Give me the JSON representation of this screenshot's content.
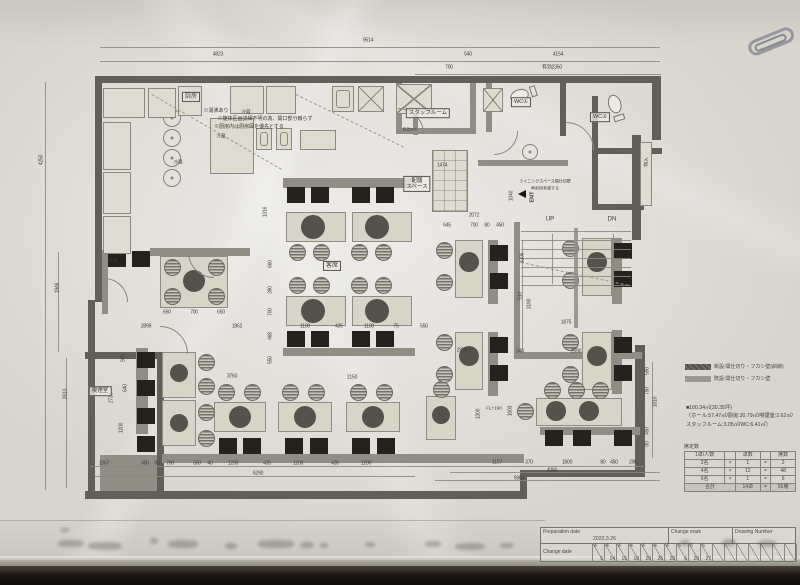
{
  "legend": {
    "items": [
      {
        "label": "新設:間仕切り・フカシ壁(斜線)",
        "swatch_color": "#504e47"
      },
      {
        "label": "既設:間仕切り・フカシ壁",
        "swatch_color": "#9b988f"
      }
    ]
  },
  "area_summary": {
    "line1": "■100.34㎡(30.35坪)",
    "line2": "〔ホール:57.47㎡/厨房:30.79㎡/喫煙室:2.62㎡/",
    "line3": "スタッフルーム:3.05㎡/WC:6.41㎡〕"
  },
  "seat_table": {
    "title": "席定数",
    "headers": [
      "1卓/人数",
      "卓数",
      "席数"
    ],
    "rows": [
      [
        "2名",
        "×",
        "1",
        "=",
        "2"
      ],
      [
        "4名",
        "×",
        "12",
        "=",
        "48"
      ],
      [
        "6名",
        "×",
        "1",
        "=",
        "6"
      ]
    ],
    "total_label": "合計",
    "total_tables": "14卓",
    "total_seats": "56席"
  },
  "title_block": {
    "prep_label": "Preparation date",
    "prep_date": "2022.3.26",
    "change_mark_label": "Change mark",
    "drawing_number_label": "Drawing Number",
    "change_date_label": "Change date",
    "change_dates": [
      "4/5",
      "4/14",
      "4/15",
      "4/18",
      "4/20",
      "4/26",
      "4/28",
      "5/6",
      "5/20",
      "5/27",
      "",
      "",
      "",
      "",
      "",
      "",
      ""
    ]
  },
  "plan": {
    "labels": [
      {
        "t": "厨房",
        "x": 191,
        "y": 97,
        "b": 1,
        "s": 6
      },
      {
        "t": "※湯沸あり",
        "x": 216,
        "y": 111,
        "s": 5
      },
      {
        "t": "※躯体区画詳細不明の為、開口部分触らず",
        "x": 265,
        "y": 119,
        "s": 5
      },
      {
        "t": "※厨房内は厨房図を優先とする",
        "x": 249,
        "y": 127,
        "s": 5
      },
      {
        "t": "冷蔵",
        "x": 246,
        "y": 112,
        "s": 4.5
      },
      {
        "t": "冷蔵",
        "x": 221,
        "y": 136,
        "s": 4.5
      },
      {
        "t": "冷蔵",
        "x": 178,
        "y": 162,
        "s": 4.5
      },
      {
        "t": "冷蔵",
        "x": 113,
        "y": 261,
        "s": 4.5
      },
      {
        "t": "スタッフルーム",
        "x": 428,
        "y": 113,
        "b": 1,
        "s": 5.5
      },
      {
        "t": "WC①",
        "x": 521,
        "y": 102,
        "b": 1,
        "s": 5.5
      },
      {
        "t": "WC②",
        "x": 600,
        "y": 117,
        "b": 1,
        "s": 5.5
      },
      {
        "t": "配膳\nスペース",
        "x": 417,
        "y": 184,
        "b": 1,
        "s": 5.5
      },
      {
        "t": "客席",
        "x": 332,
        "y": 266,
        "b": 1,
        "s": 6
      },
      {
        "t": "喫煙室",
        "x": 100,
        "y": 391,
        "b": 1,
        "s": 5.5
      },
      {
        "t": "UP",
        "x": 550,
        "y": 220,
        "s": 6
      },
      {
        "t": "DN",
        "x": 612,
        "y": 220,
        "s": 6
      },
      {
        "t": "ENT",
        "x": 533,
        "y": 197,
        "v": 1,
        "s": 5.5,
        "bold": 1
      },
      {
        "t": "物入",
        "x": 646,
        "y": 162,
        "v": 1,
        "s": 4.5
      },
      {
        "t": "ライニングスペース間仕切壁",
        "x": 545,
        "y": 182,
        "s": 4
      },
      {
        "t": "再利用考慮する",
        "x": 545,
        "y": 189,
        "s": 4
      },
      {
        "t": "有効920",
        "x": 410,
        "y": 130,
        "s": 4
      },
      {
        "t": "FL+190",
        "x": 494,
        "y": 408,
        "s": 4.5
      }
    ],
    "dims": [
      [
        "9514",
        368,
        41,
        0
      ],
      [
        "4823",
        218,
        55,
        0
      ],
      [
        "540",
        468,
        55,
        0
      ],
      [
        "4154",
        558,
        55,
        0
      ],
      [
        "700",
        449,
        68,
        0
      ],
      [
        "有効2350",
        552,
        68,
        0
      ],
      [
        "1067",
        104,
        464,
        0
      ],
      [
        "450",
        145,
        464,
        0
      ],
      [
        "80",
        157,
        464,
        0
      ],
      [
        "700",
        170,
        464,
        0
      ],
      [
        "350",
        197,
        464,
        0
      ],
      [
        "40",
        210,
        464,
        0
      ],
      [
        "1200",
        233,
        464,
        0
      ],
      [
        "435",
        267,
        464,
        0
      ],
      [
        "1200",
        298,
        464,
        0
      ],
      [
        "435",
        335,
        464,
        0
      ],
      [
        "1200",
        366,
        464,
        0
      ],
      [
        "6290",
        258,
        474,
        0
      ],
      [
        "1157",
        497,
        463,
        0
      ],
      [
        "370",
        529,
        463,
        0
      ],
      [
        "1800",
        567,
        463,
        0
      ],
      [
        "80",
        603,
        463,
        0
      ],
      [
        "450",
        614,
        463,
        0
      ],
      [
        "295",
        633,
        463,
        0
      ],
      [
        "4060",
        552,
        471,
        0
      ],
      [
        "5983",
        519,
        479,
        0
      ],
      [
        "4250",
        42,
        160,
        1
      ],
      [
        "1946",
        58,
        288,
        1
      ],
      [
        "2610",
        66,
        394,
        1
      ],
      [
        "650",
        167,
        313,
        0
      ],
      [
        "700",
        194,
        313,
        0
      ],
      [
        "650",
        221,
        313,
        0
      ],
      [
        "2899",
        146,
        327,
        0
      ],
      [
        "1862",
        237,
        327,
        0
      ],
      [
        "1100",
        305,
        327,
        0
      ],
      [
        "435",
        339,
        327,
        0
      ],
      [
        "1100",
        369,
        327,
        0
      ],
      [
        "75",
        396,
        327,
        0
      ],
      [
        "550",
        424,
        327,
        0
      ],
      [
        "1875",
        566,
        323,
        0
      ],
      [
        "2072",
        474,
        216,
        0
      ],
      [
        "645",
        447,
        226,
        0
      ],
      [
        "700",
        474,
        226,
        0
      ],
      [
        "80",
        487,
        226,
        0
      ],
      [
        "450",
        500,
        226,
        0
      ],
      [
        "1474",
        442,
        166,
        0
      ],
      [
        "2150",
        352,
        378,
        0
      ],
      [
        "3760",
        232,
        377,
        0
      ],
      [
        "2950",
        462,
        351,
        0
      ],
      [
        "1300",
        479,
        414,
        1
      ],
      [
        "1603",
        511,
        411,
        1
      ],
      [
        "2590",
        576,
        352,
        0
      ],
      [
        "340",
        520,
        352,
        0
      ],
      [
        "1040",
        512,
        196,
        1
      ],
      [
        "1306",
        523,
        258,
        1
      ],
      [
        "510",
        521,
        296,
        1
      ],
      [
        "3190",
        530,
        304,
        1
      ],
      [
        "900",
        124,
        358,
        1
      ],
      [
        "2730",
        112,
        398,
        1
      ],
      [
        "640",
        126,
        388,
        1
      ],
      [
        "1200",
        122,
        428,
        1
      ],
      [
        "1316",
        266,
        212,
        1
      ],
      [
        "660",
        271,
        264,
        1
      ],
      [
        "390",
        271,
        290,
        1
      ],
      [
        "700",
        271,
        312,
        1
      ],
      [
        "468",
        271,
        336,
        1
      ],
      [
        "550",
        271,
        360,
        1
      ],
      [
        "590",
        648,
        371,
        1
      ],
      [
        "750",
        648,
        391,
        1
      ],
      [
        "1810",
        656,
        402,
        1
      ],
      [
        "450",
        648,
        431,
        1
      ],
      [
        "80",
        648,
        444,
        1
      ]
    ],
    "walls": [
      [
        95,
        76,
        566,
        7,
        "d"
      ],
      [
        652,
        76,
        9,
        64,
        "d"
      ],
      [
        95,
        76,
        7,
        226,
        "d"
      ],
      [
        88,
        300,
        7,
        198,
        "d"
      ],
      [
        85,
        491,
        442,
        8,
        "d"
      ],
      [
        520,
        470,
        124,
        7,
        "d"
      ],
      [
        520,
        470,
        7,
        28,
        "d"
      ],
      [
        637,
        412,
        8,
        65,
        "d"
      ],
      [
        632,
        135,
        9,
        105,
        "d"
      ],
      [
        635,
        345,
        10,
        132,
        "d"
      ],
      [
        100,
        455,
        62,
        36,
        "m"
      ],
      [
        85,
        352,
        79,
        7,
        "d"
      ],
      [
        157,
        352,
        7,
        139,
        "d"
      ],
      [
        396,
        83,
        6,
        51,
        "m"
      ],
      [
        396,
        128,
        80,
        6,
        "m"
      ],
      [
        470,
        83,
        6,
        51,
        "m"
      ],
      [
        486,
        83,
        6,
        49,
        "m"
      ],
      [
        560,
        83,
        6,
        53,
        "d"
      ],
      [
        592,
        96,
        6,
        58,
        "d"
      ],
      [
        592,
        148,
        70,
        6,
        "d"
      ],
      [
        592,
        154,
        6,
        56,
        "d"
      ],
      [
        592,
        204,
        52,
        6,
        "d"
      ],
      [
        478,
        160,
        90,
        6,
        "m"
      ],
      [
        514,
        222,
        6,
        135,
        "m"
      ],
      [
        514,
        352,
        128,
        7,
        "m"
      ],
      [
        283,
        178,
        132,
        10,
        "m"
      ],
      [
        150,
        248,
        100,
        8,
        "m"
      ],
      [
        102,
        250,
        6,
        64,
        "m"
      ],
      [
        283,
        348,
        132,
        8,
        "m"
      ],
      [
        162,
        454,
        362,
        9,
        "m"
      ],
      [
        540,
        427,
        100,
        8,
        "m"
      ],
      [
        488,
        240,
        10,
        64,
        "m"
      ],
      [
        488,
        332,
        10,
        64,
        "m"
      ],
      [
        612,
        238,
        10,
        66,
        "m"
      ],
      [
        612,
        330,
        10,
        64,
        "m"
      ],
      [
        136,
        348,
        12,
        86,
        "m"
      ],
      [
        413,
        95,
        5,
        40,
        "m"
      ]
    ],
    "tables": [
      [
        286,
        212,
        60,
        30
      ],
      [
        352,
        212,
        60,
        30
      ],
      [
        286,
        296,
        60,
        30
      ],
      [
        352,
        296,
        60,
        30
      ],
      [
        160,
        256,
        68,
        52
      ],
      [
        162,
        352,
        34,
        46
      ],
      [
        162,
        400,
        34,
        46
      ],
      [
        214,
        402,
        52,
        30
      ],
      [
        278,
        402,
        54,
        30
      ],
      [
        346,
        402,
        54,
        30
      ],
      [
        536,
        398,
        86,
        28
      ],
      [
        426,
        396,
        30,
        44
      ],
      [
        455,
        240,
        28,
        58
      ],
      [
        455,
        332,
        28,
        58
      ],
      [
        582,
        238,
        30,
        58
      ],
      [
        582,
        332,
        30,
        58
      ]
    ],
    "circles": [
      [
        313,
        227,
        12
      ],
      [
        377,
        227,
        12
      ],
      [
        313,
        311,
        12
      ],
      [
        377,
        311,
        12
      ],
      [
        194,
        281,
        11
      ],
      [
        179,
        373,
        9
      ],
      [
        179,
        423,
        9
      ],
      [
        240,
        417,
        11
      ],
      [
        305,
        417,
        11
      ],
      [
        373,
        417,
        11
      ],
      [
        441,
        415,
        9
      ],
      [
        469,
        262,
        10
      ],
      [
        469,
        356,
        10
      ],
      [
        597,
        262,
        10
      ],
      [
        597,
        356,
        10
      ],
      [
        556,
        411,
        10
      ],
      [
        589,
        411,
        10
      ]
    ],
    "chairs": [
      [
        297,
        252
      ],
      [
        321,
        252
      ],
      [
        359,
        252
      ],
      [
        383,
        252
      ],
      [
        297,
        285
      ],
      [
        321,
        285
      ],
      [
        359,
        285
      ],
      [
        383,
        285
      ],
      [
        172,
        267
      ],
      [
        216,
        267
      ],
      [
        172,
        296
      ],
      [
        216,
        296
      ],
      [
        206,
        362
      ],
      [
        206,
        386
      ],
      [
        206,
        412
      ],
      [
        206,
        438
      ],
      [
        226,
        392
      ],
      [
        252,
        392
      ],
      [
        290,
        392
      ],
      [
        316,
        392
      ],
      [
        358,
        392
      ],
      [
        384,
        392
      ],
      [
        552,
        390
      ],
      [
        576,
        390
      ],
      [
        600,
        390
      ],
      [
        525,
        411
      ],
      [
        441,
        389
      ],
      [
        444,
        250
      ],
      [
        444,
        282
      ],
      [
        444,
        342
      ],
      [
        444,
        374
      ],
      [
        570,
        248
      ],
      [
        570,
        280
      ],
      [
        570,
        342
      ],
      [
        570,
        374
      ]
    ],
    "benches": [
      [
        287,
        187
      ],
      [
        311,
        187
      ],
      [
        352,
        187
      ],
      [
        376,
        187
      ],
      [
        287,
        331
      ],
      [
        311,
        331
      ],
      [
        352,
        331
      ],
      [
        376,
        331
      ],
      [
        108,
        251
      ],
      [
        132,
        251
      ],
      [
        137,
        352
      ],
      [
        137,
        380
      ],
      [
        137,
        408
      ],
      [
        137,
        436
      ],
      [
        219,
        438
      ],
      [
        243,
        438
      ],
      [
        285,
        438
      ],
      [
        310,
        438
      ],
      [
        352,
        438
      ],
      [
        377,
        438
      ],
      [
        545,
        430
      ],
      [
        573,
        430
      ],
      [
        614,
        430
      ],
      [
        490,
        245
      ],
      [
        490,
        273
      ],
      [
        490,
        337
      ],
      [
        490,
        365
      ],
      [
        614,
        243
      ],
      [
        614,
        271
      ],
      [
        614,
        337
      ],
      [
        614,
        365
      ]
    ],
    "rings": [
      [
        172,
        118,
        9
      ],
      [
        172,
        138,
        9
      ],
      [
        172,
        158,
        9
      ],
      [
        172,
        178,
        9
      ],
      [
        530,
        152,
        8
      ]
    ],
    "equip": [
      [
        103,
        88,
        42,
        30,
        ""
      ],
      [
        148,
        88,
        28,
        30,
        ""
      ],
      [
        178,
        86,
        24,
        30,
        ""
      ],
      [
        230,
        86,
        34,
        28,
        ""
      ],
      [
        266,
        86,
        30,
        28,
        ""
      ],
      [
        332,
        86,
        22,
        26,
        "s"
      ],
      [
        358,
        86,
        26,
        26,
        "x"
      ],
      [
        396,
        84,
        36,
        30,
        "x"
      ],
      [
        103,
        122,
        28,
        48,
        ""
      ],
      [
        103,
        172,
        28,
        42,
        ""
      ],
      [
        103,
        216,
        28,
        38,
        ""
      ],
      [
        210,
        118,
        44,
        56,
        ""
      ],
      [
        256,
        128,
        16,
        22,
        "s"
      ],
      [
        276,
        128,
        16,
        22,
        "s"
      ],
      [
        300,
        130,
        36,
        20,
        ""
      ],
      [
        432,
        150,
        36,
        62,
        "g"
      ],
      [
        483,
        88,
        20,
        24,
        "x"
      ],
      [
        640,
        142,
        12,
        64,
        ""
      ]
    ],
    "arcs": [
      [
        398,
        134,
        26,
        0
      ],
      [
        494,
        131,
        24,
        90
      ],
      [
        566,
        150,
        28,
        0
      ],
      [
        160,
        354,
        28,
        0
      ],
      [
        214,
        252,
        26,
        180
      ],
      [
        104,
        302,
        24,
        0
      ]
    ],
    "dashes": [
      [
        152,
        94,
        150,
        30
      ],
      [
        296,
        94,
        120,
        26
      ]
    ],
    "stair": {
      "x": 521,
      "y": 231,
      "w": 110,
      "n": 7,
      "gap": 9,
      "rail_x": 574
    },
    "lines": [
      [
        100,
        47,
        560,
        0.6
      ],
      [
        100,
        61,
        560,
        0.6
      ],
      [
        415,
        74,
        246,
        0.6
      ],
      [
        45,
        82,
        0.6,
        408
      ],
      [
        66,
        358,
        0.6,
        130
      ],
      [
        58,
        252,
        0.6,
        100
      ],
      [
        90,
        466,
        556,
        0.6
      ],
      [
        95,
        476,
        320,
        0.6
      ],
      [
        450,
        472,
        210,
        0.6
      ],
      [
        435,
        480,
        225,
        0.6
      ],
      [
        652,
        362,
        0.6,
        96
      ],
      [
        522,
        240,
        0.6,
        112
      ],
      [
        552,
        234,
        0.7,
        50
      ],
      [
        613,
        234,
        0.7,
        50
      ]
    ]
  }
}
